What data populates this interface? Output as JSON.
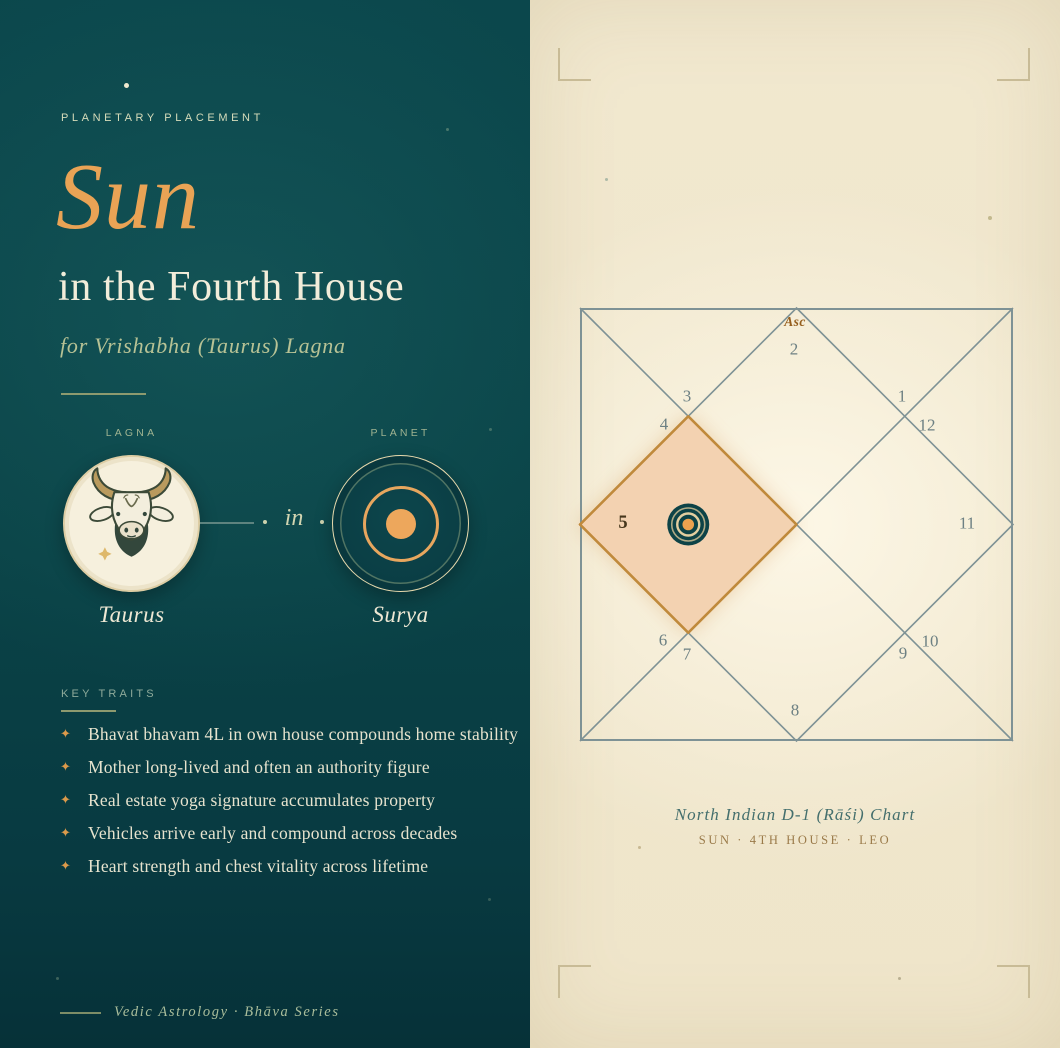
{
  "theme": {
    "left_background": "#0a4448",
    "right_background": "#f1e8cf",
    "accent_orange": "#e8a254",
    "cream_text": "#f2edda",
    "sage_text": "#b7c295",
    "chart_line": "#7e9295",
    "highlight_fill": "#f3d2b1",
    "highlight_border": "#c08a3c"
  },
  "left_panel": {
    "eyebrow": "PLANETARY PLACEMENT",
    "title": "Sun",
    "subtitle": "in the Fourth House",
    "lagna_line": "for Vrishabha (Taurus) Lagna",
    "lagna_label": "LAGNA",
    "planet_label": "PLANET",
    "connector_word": "in",
    "lagna_name": "Taurus",
    "planet_name": "Surya",
    "traits_heading": "KEY TRAITS",
    "bullet_glyph": "✦",
    "traits": [
      "Bhavat bhavam 4L in own house compounds home stability",
      "Mother long-lived and often an authority figure",
      "Real estate yoga signature accumulates property",
      "Vehicles arrive early and compound across decades",
      "Heart strength and chest vitality across lifetime"
    ],
    "footer": "Vedic Astrology · Bhāva Series"
  },
  "chart": {
    "asc_label": "Asc",
    "house_signs": [
      "2",
      "3",
      "4",
      "5",
      "6",
      "7",
      "8",
      "9",
      "10",
      "11",
      "12",
      "1"
    ],
    "caption_title": "North Indian D-1 (Rāśi) Chart",
    "caption_subtitle": "SUN · 4TH HOUSE · LEO"
  }
}
